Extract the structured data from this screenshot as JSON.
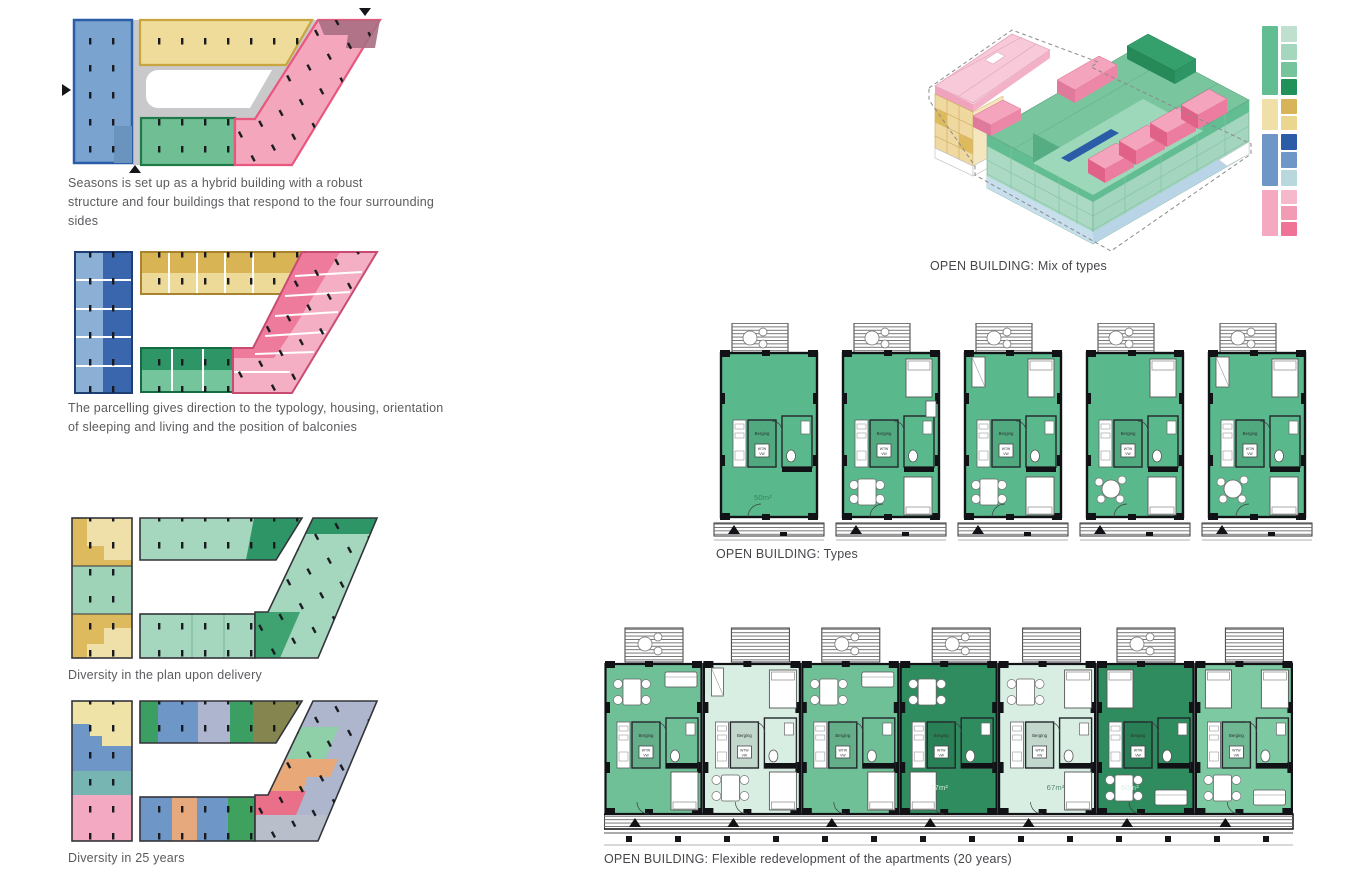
{
  "sheet": {
    "background": "#ffffff"
  },
  "captions": {
    "seasons": [
      "Seasons is set up as a hybrid building with a robust",
      "structure and four buildings that respond to the four surrounding",
      "sides"
    ],
    "parcelling": [
      "The parcelling gives direction to the typology, housing, orientation",
      "of sleeping and living and the position of balconies"
    ],
    "delivery": "Diversity in the plan upon delivery",
    "years25": "Diversity in 25 years",
    "mix_of_types": "OPEN BUILDING: Mix of types",
    "types": "OPEN BUILDING: Types",
    "flexible": "OPEN BUILDING: Flexible redevelopment of the apartments (20 years)"
  },
  "labels": {
    "berging": "Berging",
    "wtw_line1": "WTW",
    "wtw_line2": "VW"
  },
  "legend": {
    "groups": [
      {
        "name": "green",
        "tall": "#62BD92",
        "shades": [
          "#BFE0CF",
          "#A5D6BE",
          "#76C49B",
          "#1F9159"
        ]
      },
      {
        "name": "yellow",
        "tall": "#F0DFA6",
        "shades": [
          "#D7B45A",
          "#EBD68F"
        ]
      },
      {
        "name": "blue",
        "tall": "#6E97C8",
        "shades": [
          "#2A5CA8",
          "#6E97C8",
          "#B8D8DE"
        ]
      },
      {
        "name": "pink",
        "tall": "#F5A8C0",
        "shades": [
          "#F6B9CB",
          "#F29BB4",
          "#EE7397"
        ]
      }
    ]
  },
  "palette": {
    "blue": "#7BA3CF",
    "blue_dark": "#3A66AE",
    "yellow": "#EFDC9A",
    "yellow_dark": "#D9B455",
    "green": "#6FBE94",
    "green_dark": "#2E9566",
    "pink": "#F4A6BC",
    "pink_dark": "#EE7B9B",
    "gray_ring": "#C9C9CB",
    "mauve": "#A86E82",
    "lavender": "#AEB6CE",
    "teal": "#76B5B1",
    "orange": "#E8A877",
    "red": "#EA6F88",
    "olive": "#85854F",
    "navy": "#2A5CA8",
    "light_blue": "#BFD9E9"
  },
  "types": {
    "floor_color": "#5AB98C",
    "units": [
      {
        "variant": "t1",
        "area": "50m²",
        "area_color": "#35805C",
        "area_x": 34,
        "balcony_table": true
      },
      {
        "variant": "t2",
        "area": "",
        "balcony_table": true
      },
      {
        "variant": "t3",
        "area": "",
        "balcony_table": true
      },
      {
        "variant": "t4",
        "area": "",
        "balcony_table": true
      },
      {
        "variant": "t5",
        "area": "",
        "balcony_table": true
      }
    ]
  },
  "flexplan": {
    "units": [
      {
        "variant": "fa",
        "color": "#6FBF97",
        "area": "",
        "balcony_table": true,
        "balcony_x": 20
      },
      {
        "variant": "fb",
        "color": "#D8EEE3",
        "area": "",
        "balcony_table": false,
        "balcony_x": 28
      },
      {
        "variant": "fa",
        "color": "#6FBF97",
        "area": "",
        "balcony_table": true,
        "balcony_x": 20
      },
      {
        "variant": "fd",
        "color": "#2E8C5E",
        "area": "77m²",
        "area_color": "#D8EFE2",
        "area_x": 30,
        "balcony_table": true,
        "balcony_x": 32
      },
      {
        "variant": "fe",
        "color": "#D8EEE3",
        "area": "67m²",
        "area_color": "#57876F",
        "area_x": 48,
        "balcony_table": false,
        "balcony_x": 24
      },
      {
        "variant": "ff",
        "color": "#2E8C5E",
        "area": "60m²",
        "area_color": "#D8EFE2",
        "area_x": 24,
        "balcony_table": true,
        "balcony_x": 20
      },
      {
        "variant": "fg",
        "color": "#7CC9A2",
        "area": "",
        "balcony_table": false,
        "balcony_x": 30
      }
    ]
  }
}
